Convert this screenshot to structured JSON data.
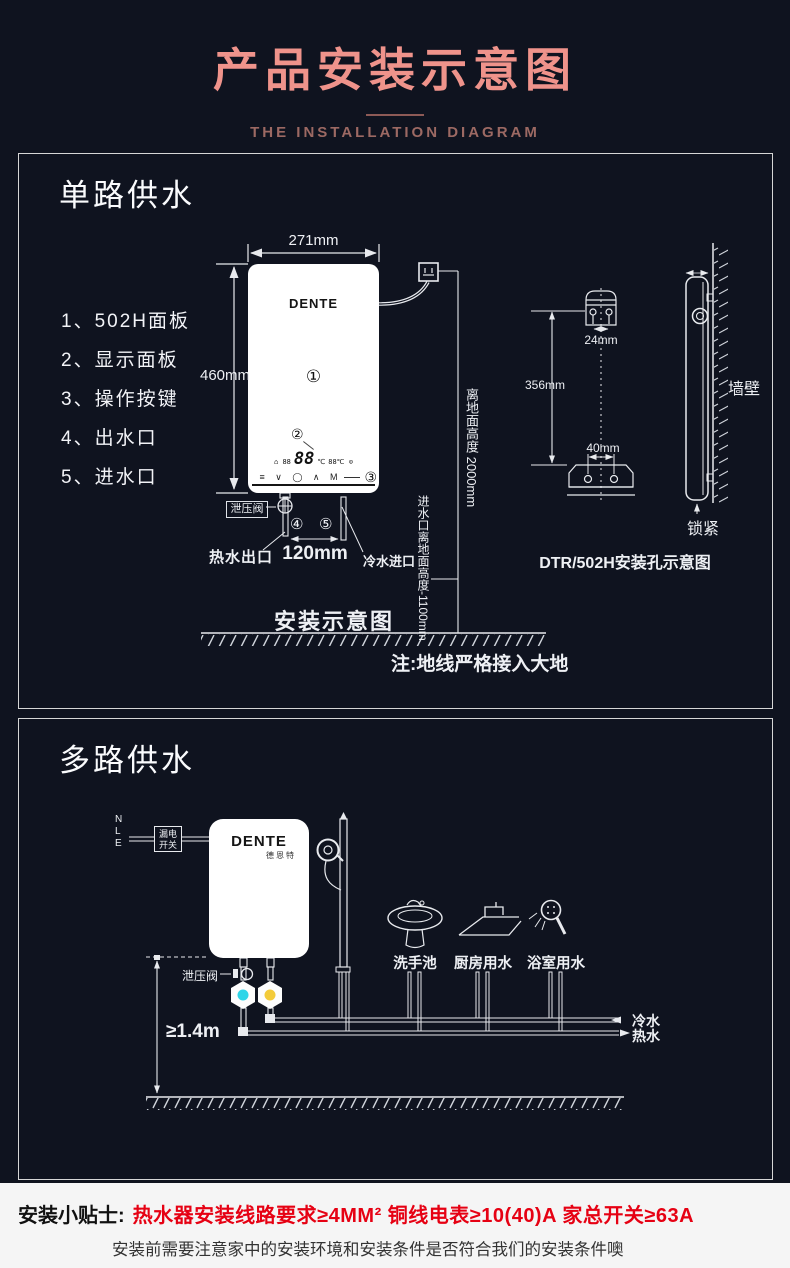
{
  "colors": {
    "accent_pink": "#ef938b",
    "warning_red": "#e60113",
    "cold_valve": "#2fd5e8",
    "hot_valve": "#f3cb3a",
    "line": "#e8eaee"
  },
  "header": {
    "title": "产品安装示意图",
    "subtitle": "THE INSTALLATION DIAGRAM"
  },
  "single": {
    "title": "单路供水",
    "parts": [
      "1、502H面板",
      "2、显示面板",
      "3、操作按键",
      "4、出水口",
      "5、进水口"
    ],
    "heater": {
      "brand": "DENTE",
      "callout_panel": "①",
      "callout_display": "②",
      "callout_buttons": "③",
      "callout_outlet": "④",
      "callout_inlet": "⑤",
      "display_left": "⌂ 88",
      "display_big": "88",
      "display_unit": "℃",
      "display_right": "88℃ ⊙",
      "buttons_row": "≡ ∨ ◯ ∧ M"
    },
    "dims": {
      "width": "271mm",
      "height": "460mm",
      "pipe_spacing": "120mm",
      "socket_height": "离地面高度 2000mm",
      "inlet_height": "进水口离地面高度-1100mm",
      "hole_gap_top": "24mm",
      "hole_span": "356mm",
      "hole_gap_bottom": "40mm"
    },
    "labels": {
      "relief_valve": "泄压阀",
      "hot_outlet": "热水出口",
      "cold_inlet": "冷水进口",
      "diagram_caption": "安装示意图",
      "ground_note": "注:地线严格接入大地",
      "wall": "墙壁",
      "lock": "锁紧",
      "mount_caption": "DTR/502H安装孔示意图"
    }
  },
  "multi": {
    "title": "多路供水",
    "wires": [
      "N",
      "L",
      "E"
    ],
    "breaker": [
      "漏电",
      "开关"
    ],
    "heater": {
      "brand": "DENTE",
      "brand_cn": "德恩特"
    },
    "labels": {
      "relief_valve": "泄压阀",
      "min_height": "≥1.4m",
      "cold": "冷水",
      "hot": "热水"
    },
    "fixtures": [
      "洗手池",
      "厨房用水",
      "浴室用水"
    ]
  },
  "tips": {
    "label": "安装小贴士:",
    "warning": "热水器安装线路要求≥4MM²  铜线电表≥10(40)A 家总开关≥63A",
    "note": "安装前需要注意家中的安装环境和安装条件是否符合我们的安装条件噢"
  }
}
